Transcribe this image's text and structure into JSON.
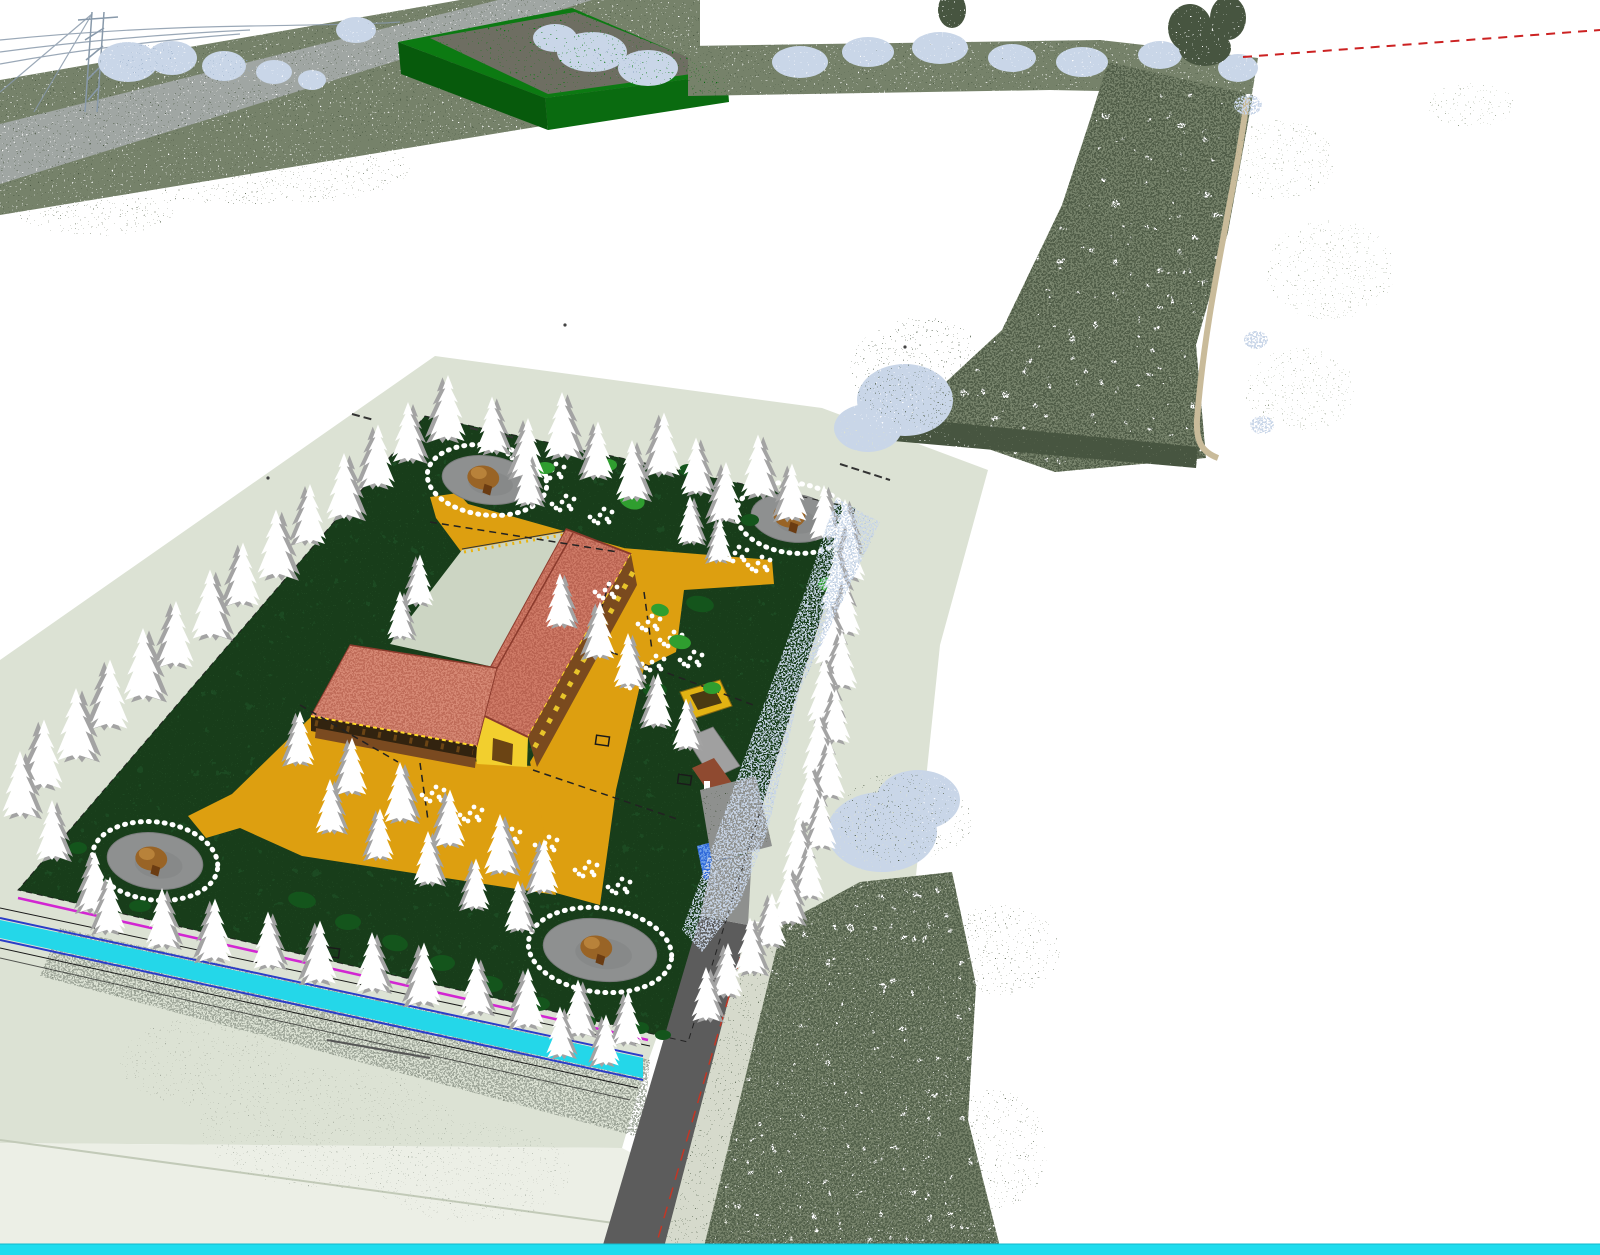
{
  "viewport": {
    "kind": "3d-point-cloud-and-cad-model-viewport",
    "width_px": 1600,
    "height_px": 1255
  },
  "colors": {
    "bg": "#ffffff",
    "plate": "#dce2d4",
    "plateBevel": "#ecefe6",
    "plateEdge": "#c2cab8",
    "garden": "#1c4a22",
    "gardenDark": "#123618",
    "gardenLight": "#2d5e33",
    "path": "#dd9f10",
    "pathFringe": "#e8b414",
    "court": "#ccd5c3",
    "roofA": "#ce7a66",
    "roofB": "#d68874",
    "roofDark": "#a9513f",
    "ridge": "#8a3a2c",
    "fascia": "#ffd92a",
    "wallYellow": "#e8c52a",
    "wallDark": "#7a4a1e",
    "timber": "#6b4414",
    "gableYellow": "#f2cf2e",
    "houseRoof": "#a0a0a0",
    "houseWall": "#8f4a30",
    "pergola": "#e2b313",
    "pergolaDark": "#4a3a12",
    "pond": "#2e68d8",
    "pondLight": "#6ea0ea",
    "plaza": "#8e9090",
    "plazaDark": "#7b7d7d",
    "canopy": "#996426",
    "canopyLight": "#b8823a",
    "trunk": "#6b3c12",
    "treeWhite": "#ffffff",
    "treeGray": "#a3a3a3",
    "bushBright": "#2f9e2f",
    "bushDark": "#14551c",
    "road": "#5c5c5c",
    "verge": "#d6dacc",
    "redLine": "#c23726",
    "cyanBar": "#1fdcee",
    "channel": "#24d7e9",
    "channelBlue": "#2a3cc8",
    "magenta": "#d226d2",
    "cadBlack": "#1a1a1a",
    "olive": "#76826a",
    "olDark": "#47543f",
    "olMid": "#5f6b54",
    "olLight": "#939e88",
    "gravel": "#9aa295",
    "bw": "#c9d6e8",
    "bwDark": "#8fa6c2",
    "boxGreen": "#0a6b10",
    "boxGreenDark": "#075a0c",
    "boxGreenTopRim": "#0c7a12",
    "boxTop": "#6e6e62",
    "roadTL": "#a0a6a3",
    "pylon": "#8899aa",
    "redDash": "#cc2222",
    "track": "#c9bb9a",
    "colonnadeShadow": "#32230f"
  },
  "scene": {
    "trees": [
      [
        408,
        432,
        1.0,
        0
      ],
      [
        448,
        408,
        1.1,
        1
      ],
      [
        492,
        425,
        0.95,
        0
      ],
      [
        528,
        448,
        1.0,
        1
      ],
      [
        562,
        425,
        1.1,
        0
      ],
      [
        598,
        450,
        0.95,
        1
      ],
      [
        632,
        470,
        1.0,
        0
      ],
      [
        664,
        444,
        1.05,
        1
      ],
      [
        696,
        466,
        0.95,
        0
      ],
      [
        726,
        492,
        1.0,
        1
      ],
      [
        758,
        466,
        1.05,
        0
      ],
      [
        792,
        492,
        0.95,
        1
      ],
      [
        824,
        512,
        0.9,
        0
      ],
      [
        378,
        456,
        1.05,
        1
      ],
      [
        344,
        486,
        1.1,
        0
      ],
      [
        310,
        514,
        1.0,
        1
      ],
      [
        276,
        544,
        1.15,
        0
      ],
      [
        243,
        574,
        1.05,
        1
      ],
      [
        210,
        604,
        1.15,
        0
      ],
      [
        176,
        634,
        1.1,
        1
      ],
      [
        143,
        664,
        1.2,
        0
      ],
      [
        110,
        694,
        1.15,
        1
      ],
      [
        76,
        724,
        1.2,
        0
      ],
      [
        44,
        754,
        1.15,
        1
      ],
      [
        20,
        784,
        1.1,
        0
      ],
      [
        52,
        830,
        1.0,
        0
      ],
      [
        95,
        882,
        1.0,
        1
      ],
      [
        110,
        905,
        0.95,
        1
      ],
      [
        162,
        918,
        1.0,
        0
      ],
      [
        215,
        930,
        1.05,
        1
      ],
      [
        268,
        940,
        0.95,
        0
      ],
      [
        320,
        952,
        1.05,
        1
      ],
      [
        372,
        962,
        1.0,
        0
      ],
      [
        424,
        974,
        1.05,
        1
      ],
      [
        476,
        986,
        0.95,
        0
      ],
      [
        528,
        998,
        1.0,
        1
      ],
      [
        578,
        1008,
        0.95,
        0
      ],
      [
        628,
        1018,
        0.9,
        1
      ],
      [
        560,
        1032,
        0.85,
        0
      ],
      [
        606,
        1040,
        0.85,
        1
      ],
      [
        845,
        526,
        0.9,
        0
      ],
      [
        850,
        552,
        0.95,
        1
      ],
      [
        836,
        580,
        1.0,
        0
      ],
      [
        846,
        608,
        0.9,
        1
      ],
      [
        830,
        634,
        1.0,
        0
      ],
      [
        842,
        660,
        0.95,
        1
      ],
      [
        824,
        690,
        1.05,
        0
      ],
      [
        836,
        716,
        0.9,
        1
      ],
      [
        818,
        744,
        1.0,
        0
      ],
      [
        830,
        770,
        0.95,
        1
      ],
      [
        810,
        796,
        1.0,
        0
      ],
      [
        822,
        822,
        0.9,
        1
      ],
      [
        798,
        848,
        1.0,
        0
      ],
      [
        810,
        872,
        0.9,
        1
      ],
      [
        788,
        896,
        0.95,
        0
      ],
      [
        772,
        920,
        0.9,
        1
      ],
      [
        750,
        946,
        0.95,
        0
      ],
      [
        728,
        970,
        0.9,
        1
      ],
      [
        706,
        994,
        0.9,
        0
      ],
      [
        560,
        600,
        0.9,
        0
      ],
      [
        600,
        630,
        0.95,
        1
      ],
      [
        628,
        660,
        0.9,
        0
      ],
      [
        658,
        700,
        0.9,
        1
      ],
      [
        686,
        724,
        0.85,
        0
      ],
      [
        352,
        766,
        0.95,
        1
      ],
      [
        400,
        792,
        1.0,
        0
      ],
      [
        450,
        818,
        0.95,
        1
      ],
      [
        500,
        844,
        1.0,
        0
      ],
      [
        544,
        866,
        0.9,
        1
      ],
      [
        330,
        806,
        0.9,
        0
      ],
      [
        380,
        834,
        0.85,
        1
      ],
      [
        428,
        858,
        0.9,
        0
      ],
      [
        476,
        884,
        0.85,
        1
      ],
      [
        518,
        906,
        0.85,
        0
      ],
      [
        300,
        738,
        0.9,
        1
      ],
      [
        528,
        480,
        0.85,
        0
      ],
      [
        420,
        580,
        0.85,
        1
      ],
      [
        400,
        615,
        0.8,
        0
      ],
      [
        690,
        520,
        0.8,
        0
      ],
      [
        720,
        540,
        0.75,
        1
      ]
    ],
    "bushes": [
      [
        632,
        500,
        13,
        9,
        "bushBright",
        20
      ],
      [
        828,
        584,
        10,
        7,
        "bushBright",
        0
      ],
      [
        680,
        642,
        11,
        7,
        "bushBright",
        10
      ],
      [
        545,
        468,
        10,
        6,
        "bushBright",
        0
      ],
      [
        608,
        465,
        9,
        6,
        "bushBright",
        0
      ],
      [
        712,
        688,
        9,
        6,
        "bushBright",
        0
      ],
      [
        660,
        610,
        9,
        6,
        "bushBright",
        15
      ],
      [
        700,
        604,
        14,
        8,
        "bushDark",
        10
      ],
      [
        655,
        690,
        12,
        7,
        "bushDark",
        0
      ],
      [
        640,
        1028,
        9,
        6,
        "bushDark",
        0
      ],
      [
        663,
        1035,
        8,
        5,
        "bushDark",
        0
      ],
      [
        100,
        888,
        12,
        7,
        "bushDark",
        0
      ],
      [
        140,
        906,
        11,
        6,
        "bushDark",
        0
      ],
      [
        302,
        900,
        14,
        8,
        "bushDark",
        10
      ],
      [
        348,
        922,
        13,
        8,
        "bushDark",
        0
      ],
      [
        395,
        943,
        13,
        8,
        "bushDark",
        12
      ],
      [
        442,
        963,
        13,
        8,
        "bushDark",
        0
      ],
      [
        490,
        984,
        13,
        8,
        "bushDark",
        8
      ],
      [
        538,
        1004,
        12,
        7,
        "bushDark",
        0
      ],
      [
        585,
        1022,
        11,
        7,
        "bushDark",
        0
      ],
      [
        78,
        848,
        9,
        6,
        "bushDark",
        0
      ],
      [
        688,
        470,
        9,
        6,
        "bushDark",
        0
      ],
      [
        750,
        520,
        9,
        6,
        "bushDark",
        0
      ]
    ],
    "shrub_clusters": [
      [
        562,
        502
      ],
      [
        600,
        515
      ],
      [
        648,
        622
      ],
      [
        670,
        638
      ],
      [
        690,
        658
      ],
      [
        735,
        553
      ],
      [
        758,
        563
      ],
      [
        652,
        662
      ],
      [
        632,
        680
      ],
      [
        545,
        843
      ],
      [
        432,
        793
      ],
      [
        470,
        813
      ],
      [
        508,
        835
      ],
      [
        585,
        868
      ],
      [
        618,
        885
      ],
      [
        552,
        470
      ],
      [
        518,
        452
      ],
      [
        605,
        590
      ]
    ],
    "plazas": [
      {
        "cx": 487,
        "cy": 480,
        "rx": 45,
        "ry": 24,
        "rot": 7
      },
      {
        "cx": 793,
        "cy": 518,
        "rx": 42,
        "ry": 24,
        "rot": 7
      },
      {
        "cx": 155,
        "cy": 861,
        "rx": 48,
        "ry": 28,
        "rot": 7
      },
      {
        "cx": 600,
        "cy": 950,
        "rx": 57,
        "ry": 31,
        "rot": 7
      }
    ],
    "speckles": [
      [
        128,
        62,
        30,
        20,
        "bw",
        "d",
        1
      ],
      [
        172,
        58,
        25,
        17,
        "bw",
        "d",
        1
      ],
      [
        224,
        66,
        22,
        15,
        "bw",
        "d",
        1
      ],
      [
        274,
        72,
        18,
        12,
        "bw",
        "d",
        1
      ],
      [
        312,
        80,
        14,
        10,
        "bw",
        "d",
        1
      ],
      [
        356,
        30,
        20,
        13,
        "bw",
        "d",
        1
      ],
      [
        150,
        60,
        30,
        18,
        "bwDark",
        "s",
        1
      ],
      [
        230,
        68,
        24,
        14,
        "bwDark",
        "s",
        1
      ],
      [
        592,
        52,
        35,
        20,
        "bw",
        "d",
        1
      ],
      [
        648,
        68,
        30,
        18,
        "bw",
        "d",
        1
      ],
      [
        555,
        38,
        22,
        14,
        "bw",
        "d",
        1
      ],
      [
        620,
        60,
        30,
        16,
        "bwDark",
        "s",
        1
      ],
      [
        800,
        62,
        28,
        16,
        "bw",
        "d",
        1
      ],
      [
        868,
        52,
        26,
        15,
        "bw",
        "d",
        1
      ],
      [
        940,
        48,
        28,
        16,
        "bw",
        "d",
        1
      ],
      [
        1012,
        58,
        24,
        14,
        "bw",
        "d",
        1
      ],
      [
        1082,
        62,
        26,
        15,
        "bw",
        "d",
        1
      ],
      [
        1160,
        55,
        22,
        14,
        "bw",
        "d",
        1
      ],
      [
        1238,
        68,
        20,
        14,
        "bw",
        "d",
        1
      ],
      [
        1205,
        48,
        26,
        18,
        "olDark",
        "d",
        1
      ],
      [
        952,
        10,
        14,
        18,
        "olDark",
        "d",
        1
      ],
      [
        1190,
        28,
        22,
        24,
        "olDark",
        "d",
        1
      ],
      [
        1228,
        18,
        18,
        22,
        "olDark",
        "d",
        1
      ],
      [
        1280,
        160,
        55,
        40,
        "olLight",
        "s",
        1
      ],
      [
        1330,
        270,
        65,
        50,
        "olLight",
        "s",
        1
      ],
      [
        1300,
        390,
        55,
        42,
        "olLight",
        "s",
        1
      ],
      [
        1470,
        105,
        45,
        22,
        "olLight",
        "s",
        1
      ],
      [
        1248,
        105,
        14,
        10,
        "bw",
        "m",
        1
      ],
      [
        1256,
        340,
        12,
        9,
        "bw",
        "m",
        1
      ],
      [
        1262,
        425,
        12,
        9,
        "bw",
        "m",
        1
      ],
      [
        905,
        400,
        48,
        36,
        "bw",
        "d",
        1
      ],
      [
        868,
        428,
        34,
        24,
        "bw",
        "d",
        1
      ],
      [
        920,
        372,
        70,
        55,
        "olDark",
        "s",
        1
      ],
      [
        882,
        832,
        55,
        40,
        "bw",
        "d",
        1
      ],
      [
        918,
        800,
        42,
        30,
        "bw",
        "d",
        1
      ],
      [
        900,
        818,
        60,
        45,
        "olDark",
        "s",
        1
      ],
      [
        330,
        1128,
        130,
        60,
        "gravel",
        "s",
        0.8
      ],
      [
        210,
        1062,
        90,
        45,
        "gravel",
        "s",
        0.8
      ],
      [
        470,
        1172,
        100,
        50,
        "gravel",
        "s",
        0.7
      ],
      [
        260,
        168,
        150,
        38,
        "olMid",
        "s",
        0.9
      ],
      [
        95,
        208,
        80,
        28,
        "olMid",
        "s",
        0.9
      ],
      [
        1000,
        950,
        60,
        45,
        "olMid",
        "s",
        0.9
      ],
      [
        992,
        1150,
        55,
        60,
        "olMid",
        "s",
        0.9
      ],
      [
        935,
        822,
        40,
        30,
        "olMid",
        "s",
        1
      ]
    ],
    "specks": [
      [
        565,
        325
      ],
      [
        268,
        478
      ],
      [
        905,
        347
      ]
    ]
  }
}
